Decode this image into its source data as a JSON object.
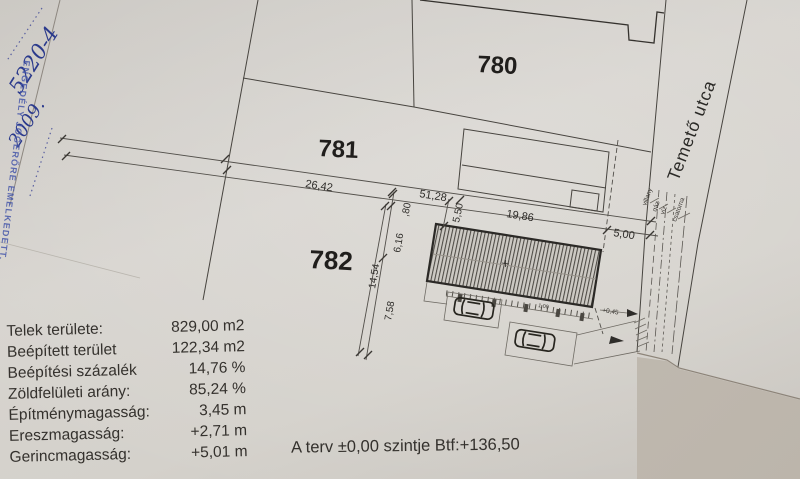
{
  "document": {
    "handwritten_number": "5220-4",
    "handwritten_year": "2009.",
    "stamp_text": "ENGEDÉLY JOGERŐRE EMELKEDETT."
  },
  "parcels": [
    {
      "id": "780"
    },
    {
      "id": "781"
    },
    {
      "id": "782"
    }
  ],
  "street": {
    "name": "Temető utca",
    "utilities": [
      "villany",
      "gáz",
      "víz",
      "csatorna"
    ]
  },
  "dimensions": {
    "front_left": "26,42",
    "front_total": "51,28",
    "building_length": "19,86",
    "street_setback": "5,00",
    "side_setback": "5,50",
    "strip": ",80",
    "building_width": "6,16",
    "depth_total": "14,54",
    "rear": "7,58",
    "driveway_level": "+0,45",
    "walk_width": "1,00"
  },
  "site_table": {
    "rows": [
      {
        "label": "Telek területe:",
        "value": "829,00 m2"
      },
      {
        "label": "Beépített terület",
        "value": "122,34 m2"
      },
      {
        "label": "Beépítési százalék",
        "value": "14,76 %"
      },
      {
        "label": "Zöldfelületi arány:",
        "value": "85,24 %"
      },
      {
        "label": "Építménymagasság:",
        "value": "3,45 m"
      },
      {
        "label": "Ereszmagasság:",
        "value": "+2,71 m"
      },
      {
        "label": "Gerincmagasság:",
        "value": "+5,01 m"
      }
    ]
  },
  "note": "A terv ±0,00 szintje Btf:+136,50",
  "colors": {
    "paper": "#d6d3ce",
    "ink": "#2e2c29",
    "stamp_blue": "#3a4a9e",
    "background": "#c1bab0"
  }
}
